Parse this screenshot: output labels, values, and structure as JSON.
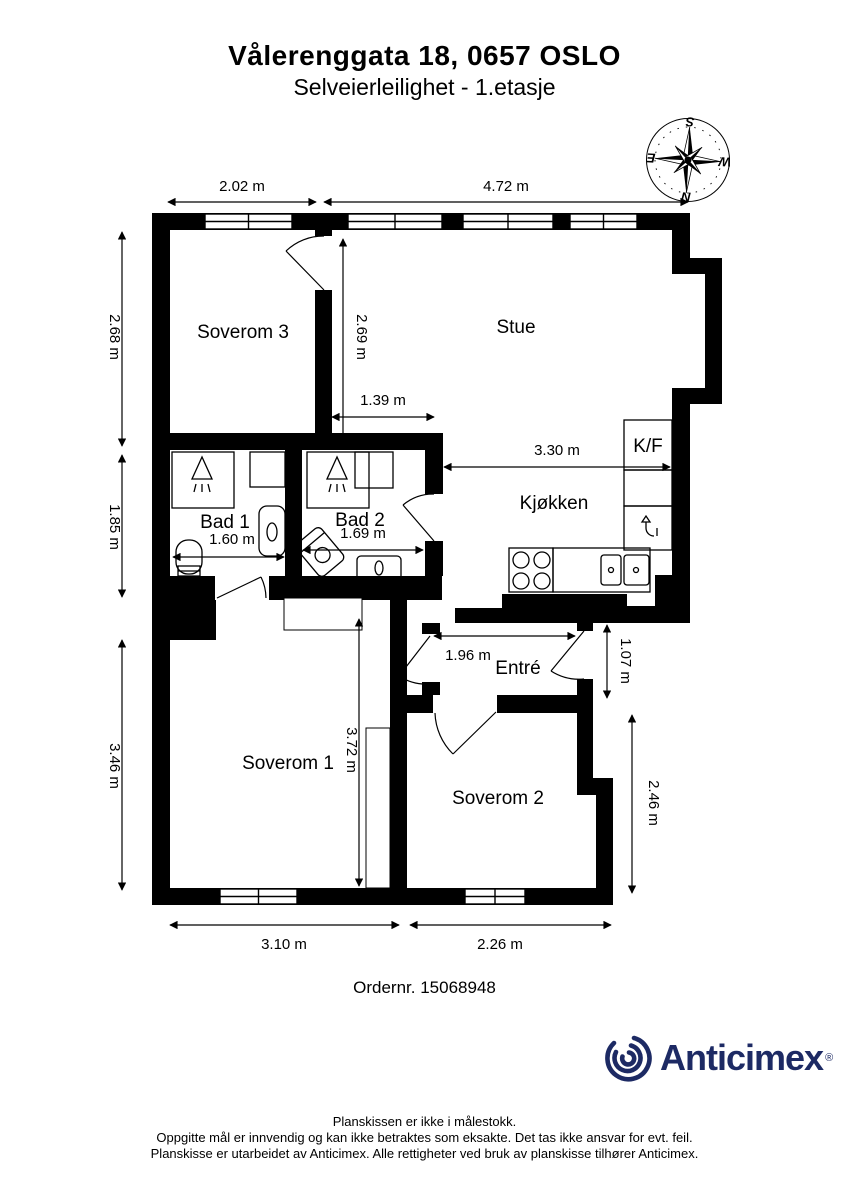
{
  "header": {
    "title": "Vålerenggata 18, 0657 OSLO",
    "subtitle": "Selveierleilighet  - 1.etasje"
  },
  "rooms": {
    "soverom3": "Soverom 3",
    "stue": "Stue",
    "bad1": "Bad 1",
    "bad2": "Bad 2",
    "kjokken": "Kjøkken",
    "kf": "K/F",
    "entre": "Entré",
    "soverom1": "Soverom 1",
    "soverom2": "Soverom 2"
  },
  "dims": {
    "soverom3_width": "2.02 m",
    "stue_width": "4.72 m",
    "soverom3_depth": "2.68 m",
    "bad_depth": "1.85 m",
    "soverom1_left_depth": "3.46 m",
    "stue_depth": "2.69 m",
    "stue_kitchen": "1.39 m",
    "kitchen_width": "3.30 m",
    "bad1_width": "1.60 m",
    "bad2_width": "1.69 m",
    "entre_width": "1.96 m",
    "entre_depth": "1.07 m",
    "soverom1_depth": "3.72 m",
    "soverom2_depth": "2.46 m",
    "soverom1_width": "3.10 m",
    "soverom2_width": "2.26 m"
  },
  "compass": {
    "north": "N",
    "south": "S",
    "east": "E",
    "west": "W"
  },
  "order": {
    "label": "Ordernr. 15068948"
  },
  "logo": {
    "name": "Anticimex",
    "registered": "®",
    "color": "#1d2a64"
  },
  "footer": {
    "line1": "Planskissen er ikke i målestokk.",
    "line2": "Oppgitte mål er innvendig og kan ikke betraktes som eksakte. Det tas ikke ansvar for evt. feil.",
    "line3": "Planskisse er utarbeidet av Anticimex. Alle rettigheter ved bruk av planskisse tilhører Anticimex."
  }
}
